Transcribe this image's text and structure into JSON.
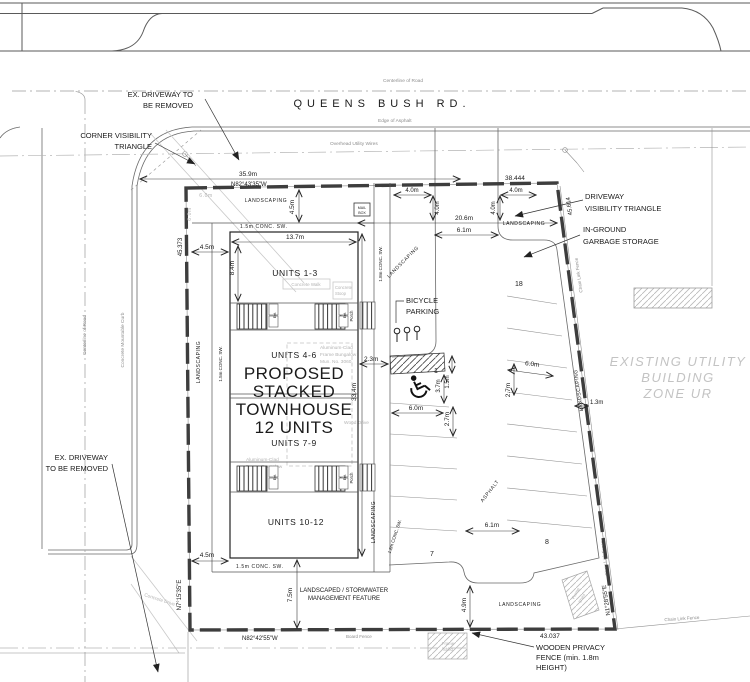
{
  "drawing": {
    "road": {
      "name": "QUEENS BUSH RD.",
      "centerline": "Centerline of Road",
      "edge_of_asphalt": "Edge of Asphalt",
      "overhead_wires": "Overhead Utility Wires",
      "mountable_curb": "Concrete Mountable Curb",
      "concrete_drive": "Concrete Drive"
    },
    "callouts": {
      "ex_driveway_top": [
        "EX. DRIVEWAY TO",
        "BE REMOVED"
      ],
      "corner_visibility": [
        "CORNER VISIBILITY",
        "TRIANGLE"
      ],
      "driveway_visibility": [
        "DRIVEWAY",
        "VISIBILITY TRIANGLE"
      ],
      "in_ground_garbage": [
        "IN-GROUND",
        "GARBAGE STORAGE"
      ],
      "bicycle_parking": [
        "BICYCLE",
        "PARKING"
      ],
      "ex_driveway_left": [
        "EX. DRIVEWAY",
        "TO BE REMOVED"
      ],
      "existing_utility": [
        "EXISTING UTILITY",
        "BUILDING",
        "ZONE UR"
      ],
      "stormwater": [
        "LANDSCAPED / STORMWATER",
        "MANAGEMENT FEATURE"
      ],
      "wooden_fence": [
        "WOODEN PRIVACY",
        "FENCE (min. 1.8m",
        "HEIGHT)"
      ]
    },
    "building": {
      "title": [
        "PROPOSED",
        "STACKED",
        "TOWNHOUSE",
        "12 UNITS"
      ],
      "units": [
        "UNITS 1-3",
        "UNITS 4-6",
        "UNITS 7-9",
        "UNITS 10-12"
      ],
      "porch": "Porch",
      "entrance": "Ent.",
      "mailbox": [
        "MAIL",
        "BOX"
      ]
    },
    "existing": {
      "bungalow": [
        "Aluminum-Clad",
        "Frame Bungalow",
        "Mun. No. 3060"
      ],
      "concrete_walk": "Concrete Walk",
      "concrete_stoop": [
        "Concrete",
        "Stoop"
      ],
      "wood_drive": "Wood Drive",
      "frame_shed": [
        "Frame",
        "Shed"
      ],
      "board_fence": "Board Fence",
      "chain_link_fence": "Chain Link Fence"
    },
    "boundary": {
      "bearing_north": "N82°43'35\"W",
      "bearing_south": "N82°42'55\"W",
      "bearing_west": "N7°15'35\"E",
      "bearing_east": "N1°28'55\"E",
      "length_north": "38.444",
      "length_east": "45.614",
      "length_west": "45.373",
      "length_south": "43.037"
    },
    "dims": {
      "d35_9": "35.9m",
      "d20_6": "20.6m",
      "d6_1": "6.1m",
      "d4_0": "4.0m",
      "d4_5": "4.5m",
      "d13_7": "13.7m",
      "d8_4": "8.4m",
      "d2_3": "2.3m",
      "d33_4": "33.4m",
      "d7_5": "7.5m",
      "d4_9": "4.9m",
      "d1_3": "1.3m",
      "d6_0": "6.0m",
      "d2_7": "2.7m",
      "d3_7": "3.7m",
      "d1_5": "1.5m",
      "sw_15": "1.5m CONC. SW.",
      "sw_18": "1.8m CONC. SW."
    },
    "labels": {
      "landscaping": "LANDSCAPING",
      "asphalt": "ASPHALT"
    },
    "parking": {
      "stalls": [
        "1",
        "7",
        "8",
        "18"
      ]
    }
  }
}
